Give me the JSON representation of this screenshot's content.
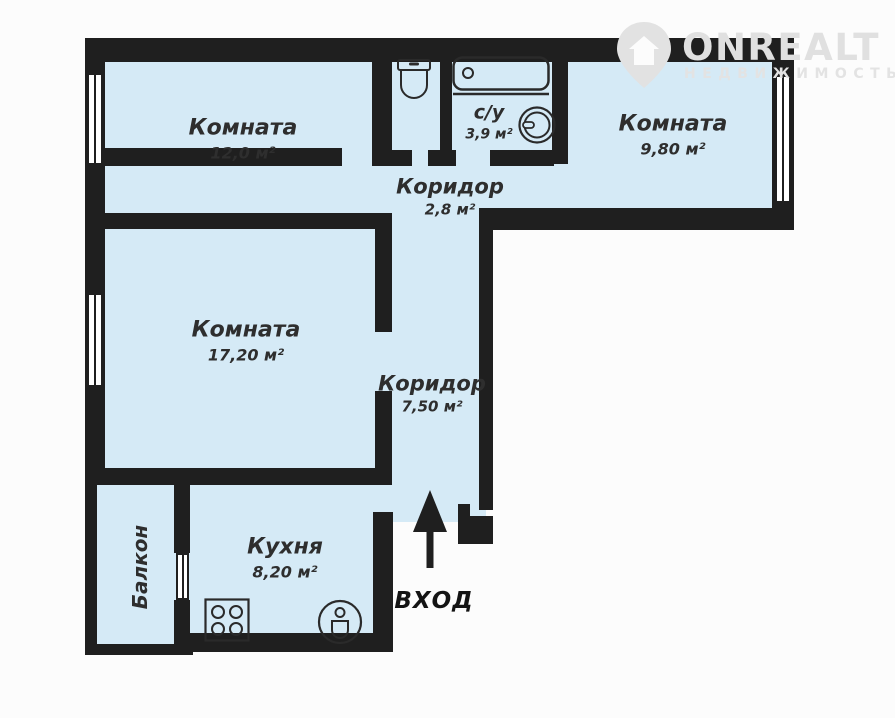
{
  "logo": {
    "brand": "ONREALT",
    "tagline": "НЕДВИЖИМОСТЬ"
  },
  "entrance": {
    "label": "ВХОД"
  },
  "rooms": [
    {
      "id": "room-12",
      "name": "Комната",
      "area": "12,0 м²"
    },
    {
      "id": "san-uzel",
      "name": "с/у",
      "area": "3,9 м²"
    },
    {
      "id": "room-9-8",
      "name": "Комната",
      "area": "9,80 м²"
    },
    {
      "id": "corridor-2-8",
      "name": "Коридор",
      "area": "2,8 м²"
    },
    {
      "id": "room-17-2",
      "name": "Комната",
      "area": "17,20 м²"
    },
    {
      "id": "corridor-7-5",
      "name": "Коридор",
      "area": "7,50 м²"
    },
    {
      "id": "kitchen",
      "name": "Кухня",
      "area": "8,20 м²"
    },
    {
      "id": "balcony",
      "name": "Балкон",
      "area": ""
    }
  ],
  "icons": [
    "toilet-icon",
    "bathtub-icon",
    "washing-machine-icon",
    "stove-icon",
    "kitchen-sink-icon",
    "entrance-arrow-icon",
    "logo-pin-icon"
  ],
  "colors": {
    "wall": "#1f1f1f",
    "floor": "#d5eaf6",
    "label": "#2e2e2e",
    "watermark": "#e0e0e0",
    "background": "#fcfcfc"
  }
}
